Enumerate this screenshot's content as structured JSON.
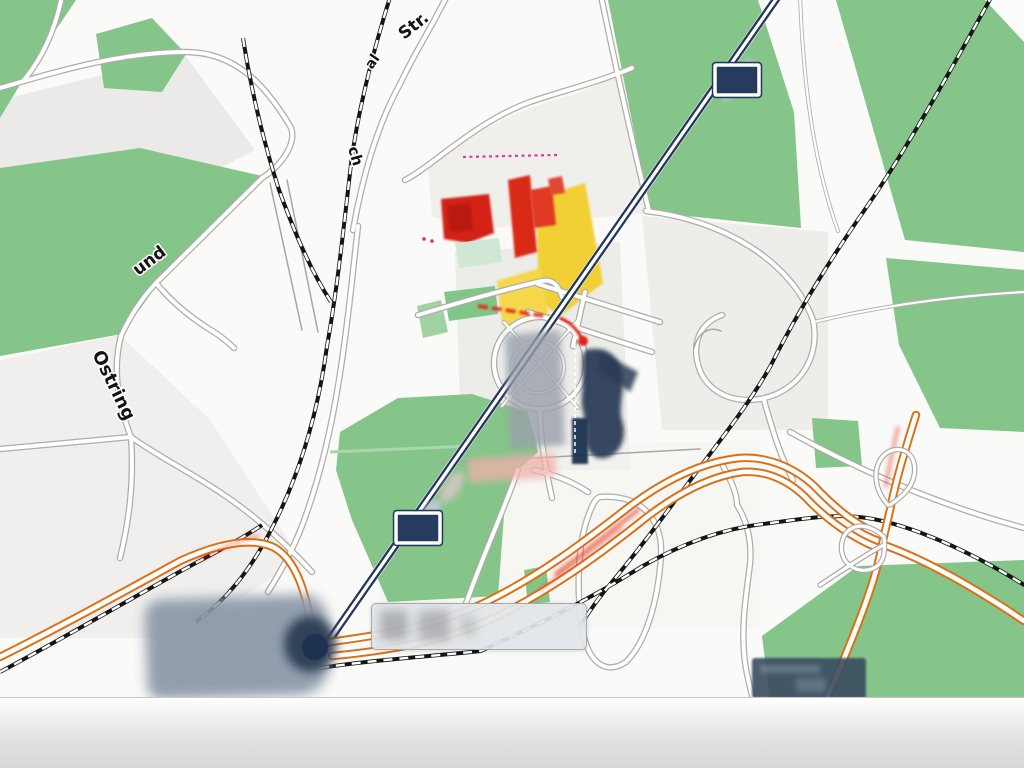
{
  "map": {
    "kind": "street-map-screenshot",
    "street_labels": [
      {
        "text": "Str."
      },
      {
        "text": "al"
      },
      {
        "text": "ch"
      },
      {
        "text": "und"
      },
      {
        "text": "Ostring"
      }
    ],
    "stations": [
      {
        "name": "railway-station-upper"
      },
      {
        "name": "railway-station-lower"
      }
    ],
    "colors": {
      "landuse_green": "#85c589",
      "rail_navy": "#24365a",
      "motorway_orange": "#dc6f14",
      "building_red": "#d22415",
      "building_yellow": "#f2cf35",
      "blur_gray": "#8a97a8",
      "dark_label_bg": "#3a4c61"
    }
  }
}
